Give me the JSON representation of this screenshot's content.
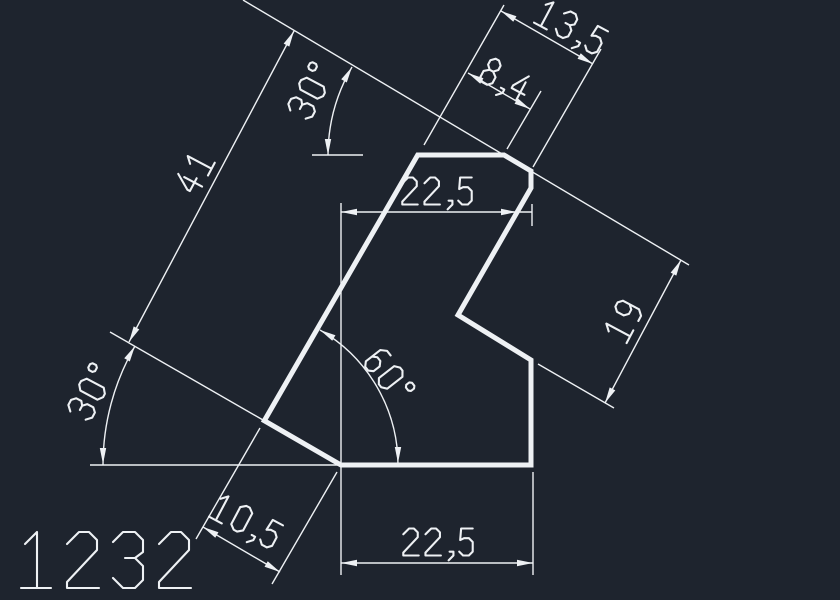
{
  "colors": {
    "background": "#1e242e",
    "lines": "#eef1f4"
  },
  "drawing_number": "1232",
  "dimensions": {
    "top_total": "13,5",
    "top_offset": "8,4",
    "top_width": "22,5",
    "edge_length": "41",
    "top_angle": "30°",
    "left_angle": "30°",
    "notch_angle": "60°",
    "notch_depth": "19",
    "chamfer": "10,5",
    "bottom_width": "22,5"
  }
}
